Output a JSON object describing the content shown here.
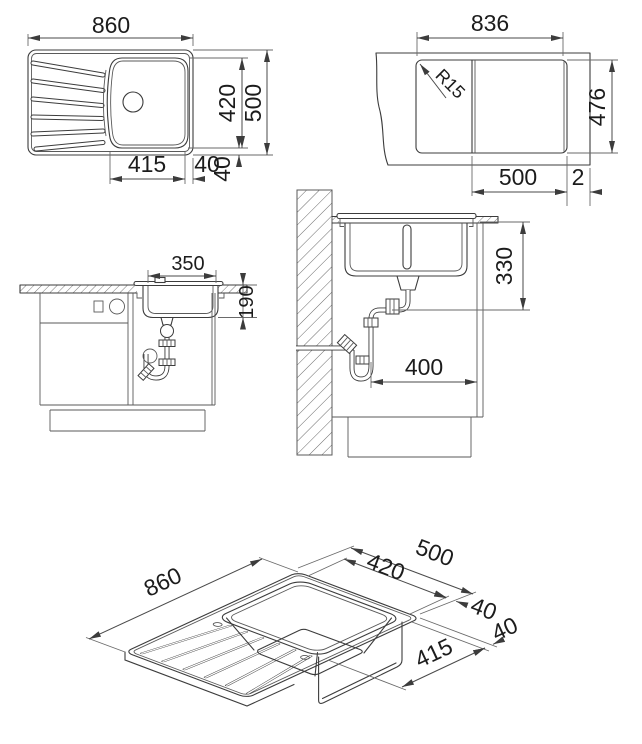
{
  "drawing": {
    "plan": {
      "overall_width": "860",
      "bowl_depth": "420",
      "overall_depth": "500",
      "bowl_width": "415",
      "bowl_right_offset": "40",
      "bowl_bottom_offset": "40"
    },
    "cutout": {
      "cutout_width": "836",
      "corner_radius": "R15",
      "cutout_depth": "476",
      "bowl_section_width": "500",
      "edge_gap": "2"
    },
    "front": {
      "bowl_inner_width": "350",
      "bowl_inner_depth": "190"
    },
    "side": {
      "outlet_height": "330",
      "outlet_distance": "400"
    },
    "iso": {
      "overall_width": "860",
      "overall_depth": "500",
      "bowl_depth": "420",
      "depth_offset": "40",
      "width_offset": "40",
      "bowl_width": "415"
    }
  },
  "colors": {
    "background": "#ffffff",
    "object_line": "#3c3c3c",
    "dimension_line": "#4a4a4a",
    "text": "#1c1c1c"
  }
}
